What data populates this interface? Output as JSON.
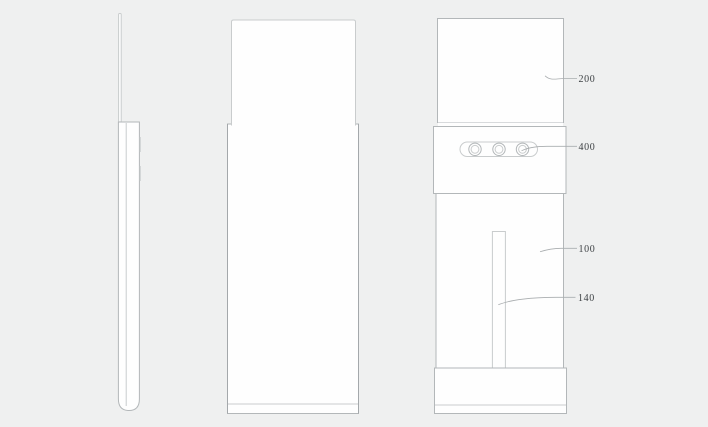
{
  "drawing": {
    "background_color": "#eff0f0",
    "outline_color": "#b3b7b9",
    "leader_color": "#a9adaf",
    "label_color": "#3d4144",
    "fill_color": "#fefefe",
    "labels": {
      "l200": "200",
      "l400": "400",
      "l100": "100",
      "l140": "140"
    }
  }
}
